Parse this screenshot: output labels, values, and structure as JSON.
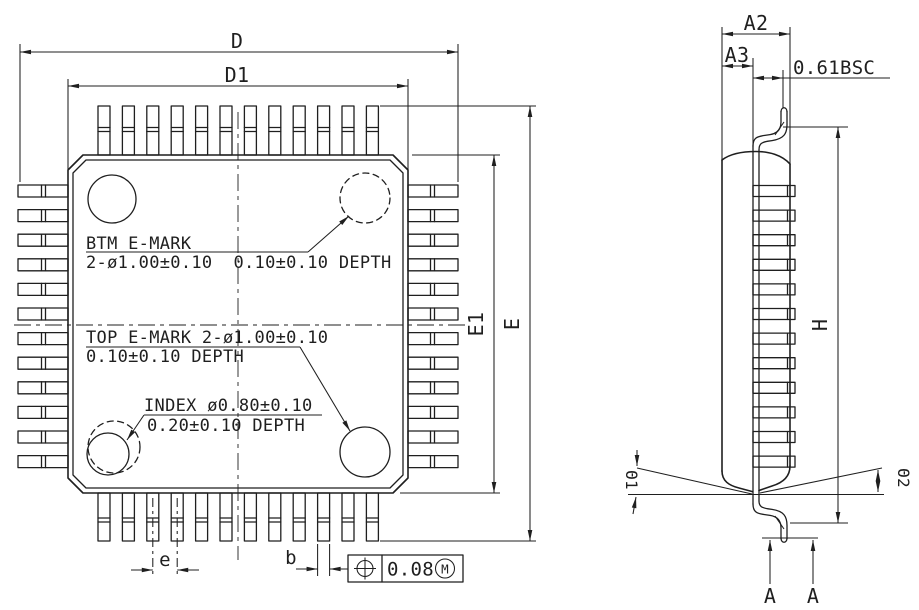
{
  "front_view": {
    "labels": {
      "d": "D",
      "d1": "D1",
      "e_overall": "E",
      "e1_body": "E1",
      "pitch": "e",
      "lead_width": "b"
    },
    "annotations": {
      "btm_emark_line1": "BTM E-MARK",
      "btm_emark_line2": "2-ø1.00±0.10  0.10±0.10 DEPTH",
      "top_emark_line1": "TOP E-MARK 2-ø1.00±0.10",
      "top_emark_line2": "0.10±0.10 DEPTH",
      "index_line1": "INDEX ø0.80±0.10",
      "index_line2": "0.20±0.10 DEPTH"
    },
    "tolerance_frame": {
      "value": "0.08",
      "modifier": "M"
    }
  },
  "side_view": {
    "labels": {
      "a2": "A2",
      "a3": "A3",
      "lead_offset_bsc": "0.61BSC",
      "h": "H",
      "theta1": "Θ1",
      "theta2": "Θ2",
      "datum": "A"
    }
  },
  "colors": {
    "line": "#1f1f1f",
    "background": "#ffffff"
  }
}
